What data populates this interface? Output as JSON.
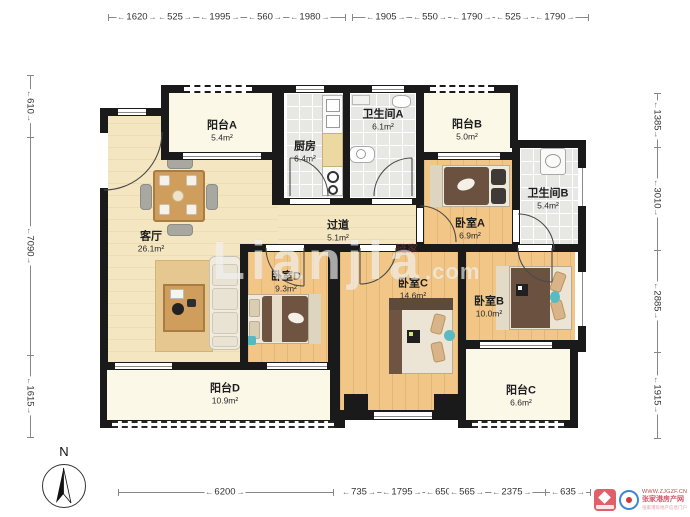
{
  "dimensions": {
    "top": [
      "1620",
      "525",
      "1995",
      "560",
      "1980",
      "1905",
      "550",
      "1790",
      "525",
      "1790"
    ],
    "left": [
      "610",
      "7090",
      "1615"
    ],
    "right": [
      "1385",
      "3010",
      "2885",
      "1915"
    ],
    "bottom": [
      "6200",
      "735",
      "1795",
      "650",
      "565",
      "2375",
      "635"
    ]
  },
  "rooms": {
    "balcony_a": {
      "name": "阳台A",
      "area": "5.4m²"
    },
    "kitchen": {
      "name": "厨房",
      "area": "6.4m²"
    },
    "bath_a": {
      "name": "卫生间A",
      "area": "6.1m²"
    },
    "balcony_b": {
      "name": "阳台B",
      "area": "5.0m²"
    },
    "bath_b": {
      "name": "卫生间B",
      "area": "5.4m²"
    },
    "living": {
      "name": "客厅",
      "area": "26.1m²"
    },
    "hallway": {
      "name": "过道",
      "area": "5.1m²"
    },
    "bedroom_a": {
      "name": "卧室A",
      "area": "6.9m²"
    },
    "bedroom_d": {
      "name": "卧室D",
      "area": "9.3m²"
    },
    "bedroom_c": {
      "name": "卧室C",
      "area": "14.6m²"
    },
    "bedroom_b": {
      "name": "卧室B",
      "area": "10.0m²"
    },
    "balcony_d": {
      "name": "阳台D",
      "area": "10.9m²"
    },
    "balcony_c": {
      "name": "阳台C",
      "area": "6.6m²"
    }
  },
  "compass": {
    "north_label": "N"
  },
  "watermark": {
    "text": "Lianjia",
    "suffix": ".com",
    "mini": "链家"
  },
  "site_badge": {
    "url": "WWW.ZJGZF.CN",
    "site_name": "张家港房产网",
    "tagline": "张家港房地产信息门户"
  },
  "colors": {
    "wall": "#1a1a1a",
    "wood_floor": "#f1c687",
    "living_floor": "#f4e6c1",
    "balcony_floor": "#fbf8e8",
    "tile_floor": "#e7e7e3",
    "bed_dark": "#6b5140",
    "pillow_tan": "#d8b488",
    "accent_teal": "#56b8c0",
    "badge_red": "#e0606a",
    "badge_blue": "#3f86d2"
  }
}
